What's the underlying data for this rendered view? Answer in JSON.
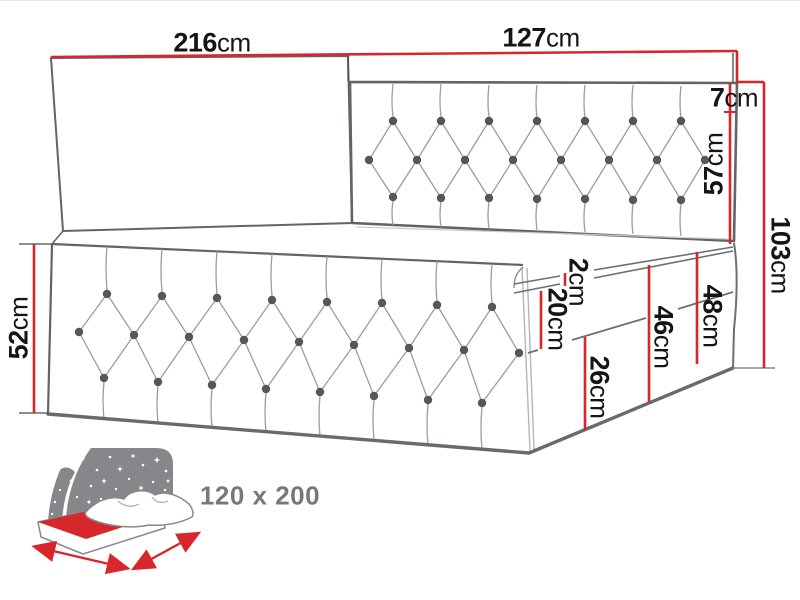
{
  "colors": {
    "dimension_red": "#d7262c",
    "outline_gray": "#636466",
    "lattice_gray": "#9c9c9e",
    "icon_gray": "#85878a",
    "text_black": "#151515"
  },
  "dimensions": {
    "total_length": {
      "value": "216",
      "unit": "cm"
    },
    "headboard_width": {
      "value": "127",
      "unit": "cm"
    },
    "headboard_top_border": {
      "value": "7",
      "unit": "cm"
    },
    "headboard_height": {
      "value": "57",
      "unit": "cm"
    },
    "total_height": {
      "value": "103",
      "unit": "cm"
    },
    "side_height": {
      "value": "52",
      "unit": "cm"
    },
    "mattress_topper": {
      "value": "2",
      "unit": "cm"
    },
    "mattress_side": {
      "value": "20",
      "unit": "cm"
    },
    "base_lower": {
      "value": "26",
      "unit": "cm"
    },
    "base_height": {
      "value": "46",
      "unit": "cm"
    },
    "base_total": {
      "value": "48",
      "unit": "cm"
    }
  },
  "icons": {
    "bed_size_icon": "bed-mattress-dimensions-icon"
  },
  "size_badge": {
    "label": "120 x 200"
  }
}
